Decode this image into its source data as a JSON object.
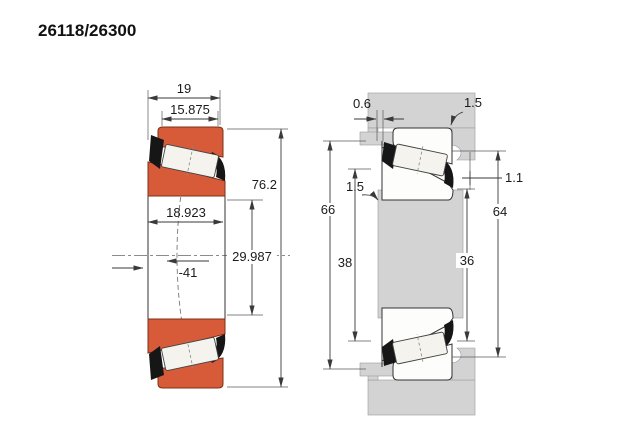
{
  "title": "26118/26300",
  "colors": {
    "orange": "#d75b39",
    "gray": "#d3d3d3",
    "cage": "#161616",
    "roller": "#f4f3ee",
    "white_part": "#fdfdfb"
  },
  "left_view": {
    "dims": {
      "width_cone": "19",
      "width_cup": "15.875",
      "outer_diameter": "76.2",
      "width_assembled": "18.923",
      "bore_diameter": "29.987",
      "load_center": "-41"
    }
  },
  "right_view": {
    "dims": {
      "side_face_gap": "0.6",
      "housing_fillet_radius": "1.5",
      "shaft_fillet_radius": "1.5",
      "housing_abutment_diameter": "66",
      "shaft_abutment_diameter": "38",
      "shaft_backing_diameter": "36",
      "housing_backing_diameter": "64",
      "axial_displacement": "1.1"
    }
  }
}
